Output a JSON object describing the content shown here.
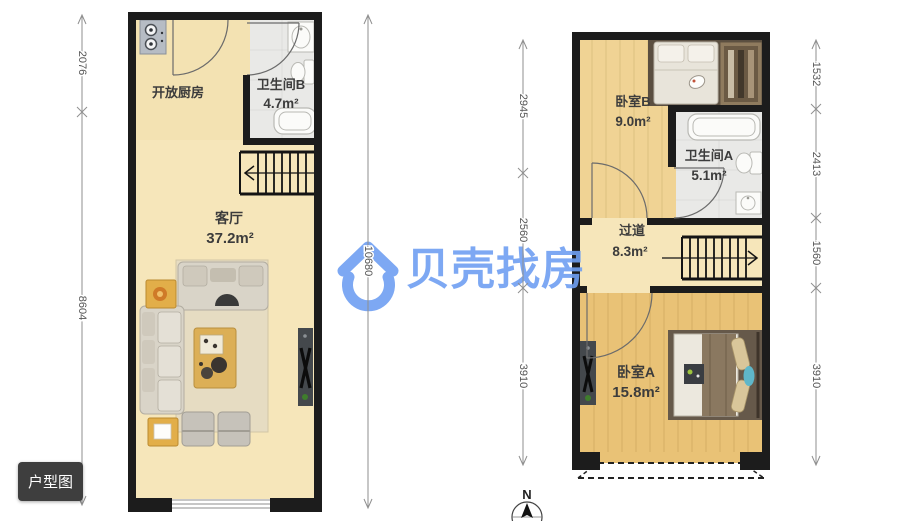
{
  "button": {
    "label": "户型图"
  },
  "watermark": {
    "brand": "贝壳找房",
    "color": "#6f9ff2"
  },
  "compass": {
    "north": "N"
  },
  "colors": {
    "wall": "#1c1c1c",
    "floor_yellow": "#f6e6ba",
    "wood_light": "#f0d394",
    "wood_orange": "#e9c276",
    "tile_gray": "#e9e9e7",
    "button_bg": "#3e3e3e"
  },
  "floor1": {
    "rooms": [
      {
        "name": "开放厨房",
        "area": ""
      },
      {
        "name": "卫生间B",
        "area": "4.7m²"
      },
      {
        "name": "客厅",
        "area": "37.2m²"
      }
    ],
    "dims_left": [
      "2076",
      "8604"
    ],
    "dims_right": [
      "10680"
    ]
  },
  "floor2": {
    "rooms": [
      {
        "name": "卧室B",
        "area": "9.0m²"
      },
      {
        "name": "卫生间A",
        "area": "5.1m²"
      },
      {
        "name": "过道",
        "area": "8.3m²"
      },
      {
        "name": "卧室A",
        "area": "15.8m²"
      }
    ],
    "dims_left": [
      "2945",
      "2560",
      "3910"
    ],
    "dims_right": [
      "1532",
      "2413",
      "1560",
      "3910"
    ]
  }
}
